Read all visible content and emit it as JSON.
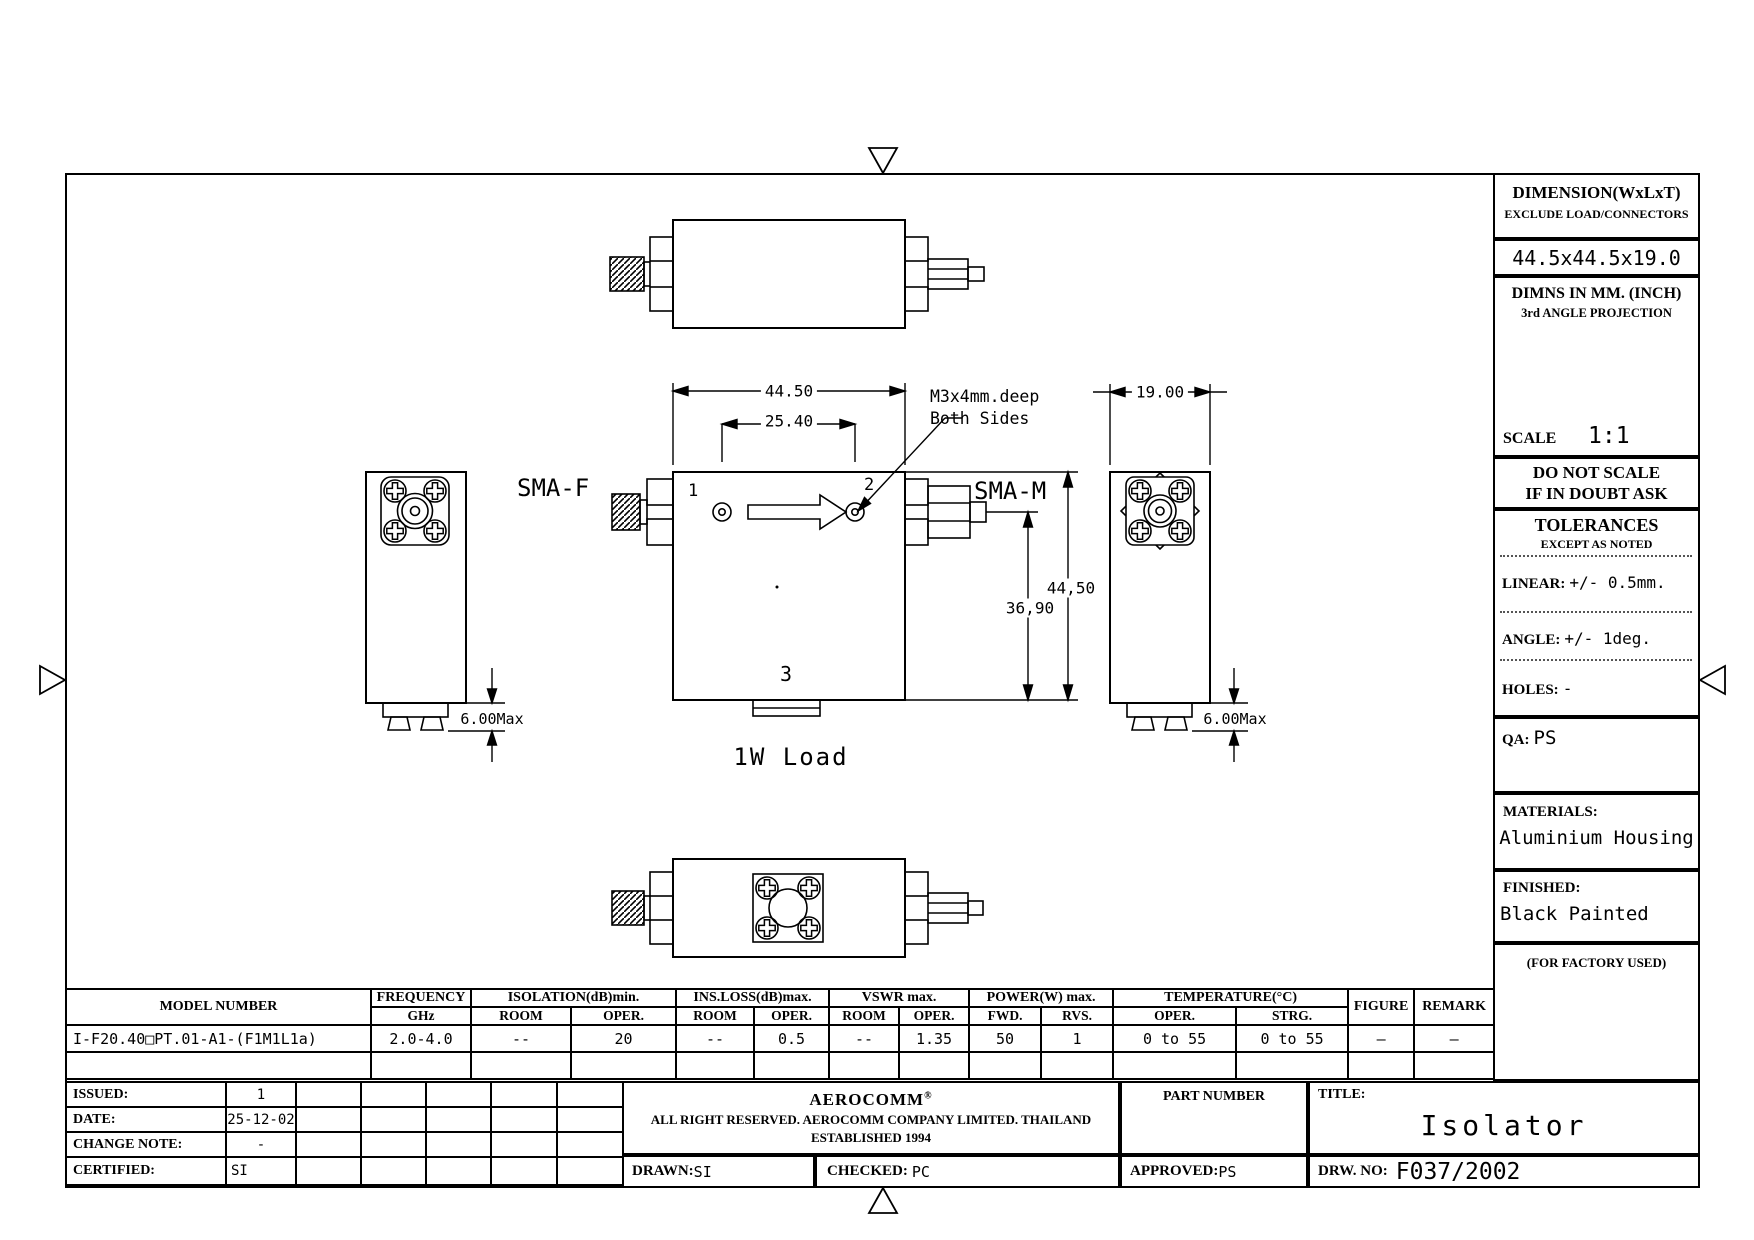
{
  "drawing": {
    "labels": {
      "sma_f": "SMA-F",
      "sma_m": "SMA-M",
      "port1": "1",
      "port2": "2",
      "port3": "3",
      "load": "1W Load",
      "screw_note1": "M3x4mm.deep",
      "screw_note2": "Both Sides"
    },
    "dims": {
      "front_width": "44.50",
      "port_spacing": "25.40",
      "front_height": "44,50",
      "port_height": "36,90",
      "side_width": "19.00",
      "tab_left": "6.00Max",
      "tab_right": "6.00Max"
    }
  },
  "title_block": {
    "dimension_label": "DIMENSION(WxLxT)",
    "dimension_note": "EXCLUDE LOAD/CONNECTORS",
    "dimension_value": "44.5x44.5x19.0",
    "units_line1": "DIMNS IN MM. (INCH)",
    "units_line2": "3rd ANGLE PROJECTION",
    "scale_label": "SCALE",
    "scale_value": "1:1",
    "warn_line1": "DO NOT SCALE",
    "warn_line2": "IF IN DOUBT ASK",
    "tolerances_title": "TOLERANCES",
    "tolerances_sub": "EXCEPT AS NOTED",
    "linear_label": "LINEAR:",
    "linear_value": "+/-  0.5mm.",
    "angle_label": "ANGLE:",
    "angle_value": "+/- 1deg.",
    "holes_label": "HOLES:",
    "holes_value": "-",
    "qa_label": "QA:",
    "qa_value": "PS",
    "materials_label": "MATERIALS:",
    "materials_value": "Aluminium Housing",
    "finished_label": "FINISHED:",
    "finished_value": "Black Painted",
    "factory_note": "(FOR FACTORY USED)"
  },
  "spec": {
    "groups": {
      "model": "MODEL NUMBER",
      "frequency_l1": "FREQUENCY",
      "frequency_l2": "GHz",
      "isolation": "ISOLATION(dB)min.",
      "ins_loss": "INS.LOSS(dB)max.",
      "vswr": "VSWR  max.",
      "power": "POWER(W)  max.",
      "temperature": "TEMPERATURE(°C)",
      "figure": "FIGURE",
      "remark": "REMARK"
    },
    "sub": {
      "room1": "ROOM",
      "oper1": "OPER.",
      "room2": "ROOM",
      "oper2": "OPER.",
      "room3": "ROOM",
      "oper3": "OPER.",
      "fwd": "FWD.",
      "rvs": "RVS.",
      "oper4": "OPER.",
      "strg": "STRG."
    },
    "row": {
      "model": "I-F20.40□PT.01-A1-(F1M1L1a)",
      "freq": "2.0-4.0",
      "iso_room": "--",
      "iso_oper": "20",
      "ins_room": "--",
      "ins_oper": "0.5",
      "vswr_room": "--",
      "vswr_oper": "1.35",
      "pwr_fwd": "50",
      "pwr_rvs": "1",
      "temp_oper": "0 to 55",
      "temp_strg": "0 to 55",
      "figure": "—",
      "remark": "—"
    }
  },
  "revision": {
    "rows": [
      {
        "label": "ISSUED:",
        "value": "1"
      },
      {
        "label": "DATE:",
        "value": "25-12-02"
      },
      {
        "label": "CHANGE NOTE:",
        "value": "-"
      },
      {
        "label": "CERTIFIED:",
        "value": "SI"
      }
    ]
  },
  "company": {
    "name": "AEROCOMM",
    "reg": "®",
    "line1": "ALL RIGHT RESERVED.  AEROCOMM  COMPANY  LIMITED.  THAILAND",
    "line2": "ESTABLISHED 1994",
    "drawn_label": "DRAWN:",
    "drawn_value": "SI",
    "checked_label": "CHECKED:",
    "checked_value": "PC"
  },
  "part": {
    "part_number_label": "PART NUMBER",
    "approved_label": "APPROVED:",
    "approved_value": "PS"
  },
  "titlebox": {
    "title_label": "TITLE:",
    "title_value": "Isolator",
    "drw_label": "DRW. NO:",
    "drw_value": "F037/2002"
  }
}
